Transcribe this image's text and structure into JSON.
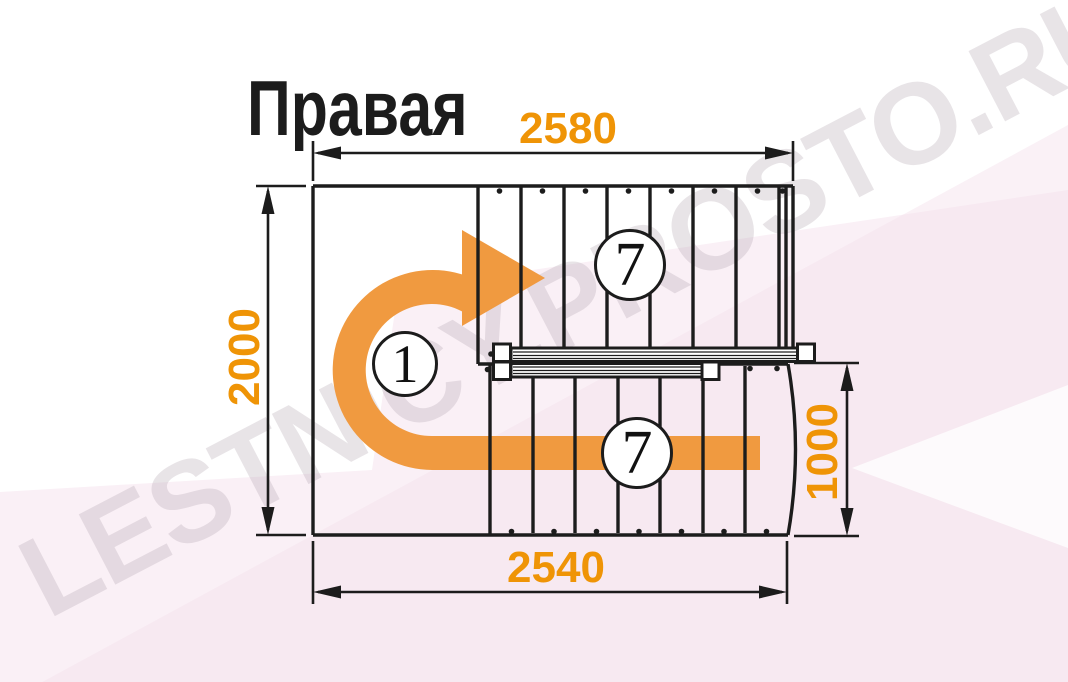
{
  "diagram": {
    "title": "Правая",
    "watermark": "LESTNICY.PROSTO.RU",
    "dimensions": {
      "width_top": "2580",
      "height_left": "2000",
      "width_bottom": "2540",
      "height_right": "1000"
    },
    "step_labels": {
      "entry_step": "1",
      "upper_flight_steps": "7",
      "lower_flight_steps": "7"
    },
    "colors": {
      "dimension_text": "#ef9406",
      "direction_arrow": "#f09a40",
      "linework": "#1c1c1c",
      "watermark_gray": "#e9e3e8",
      "background_tint": "#faf0f6"
    }
  }
}
